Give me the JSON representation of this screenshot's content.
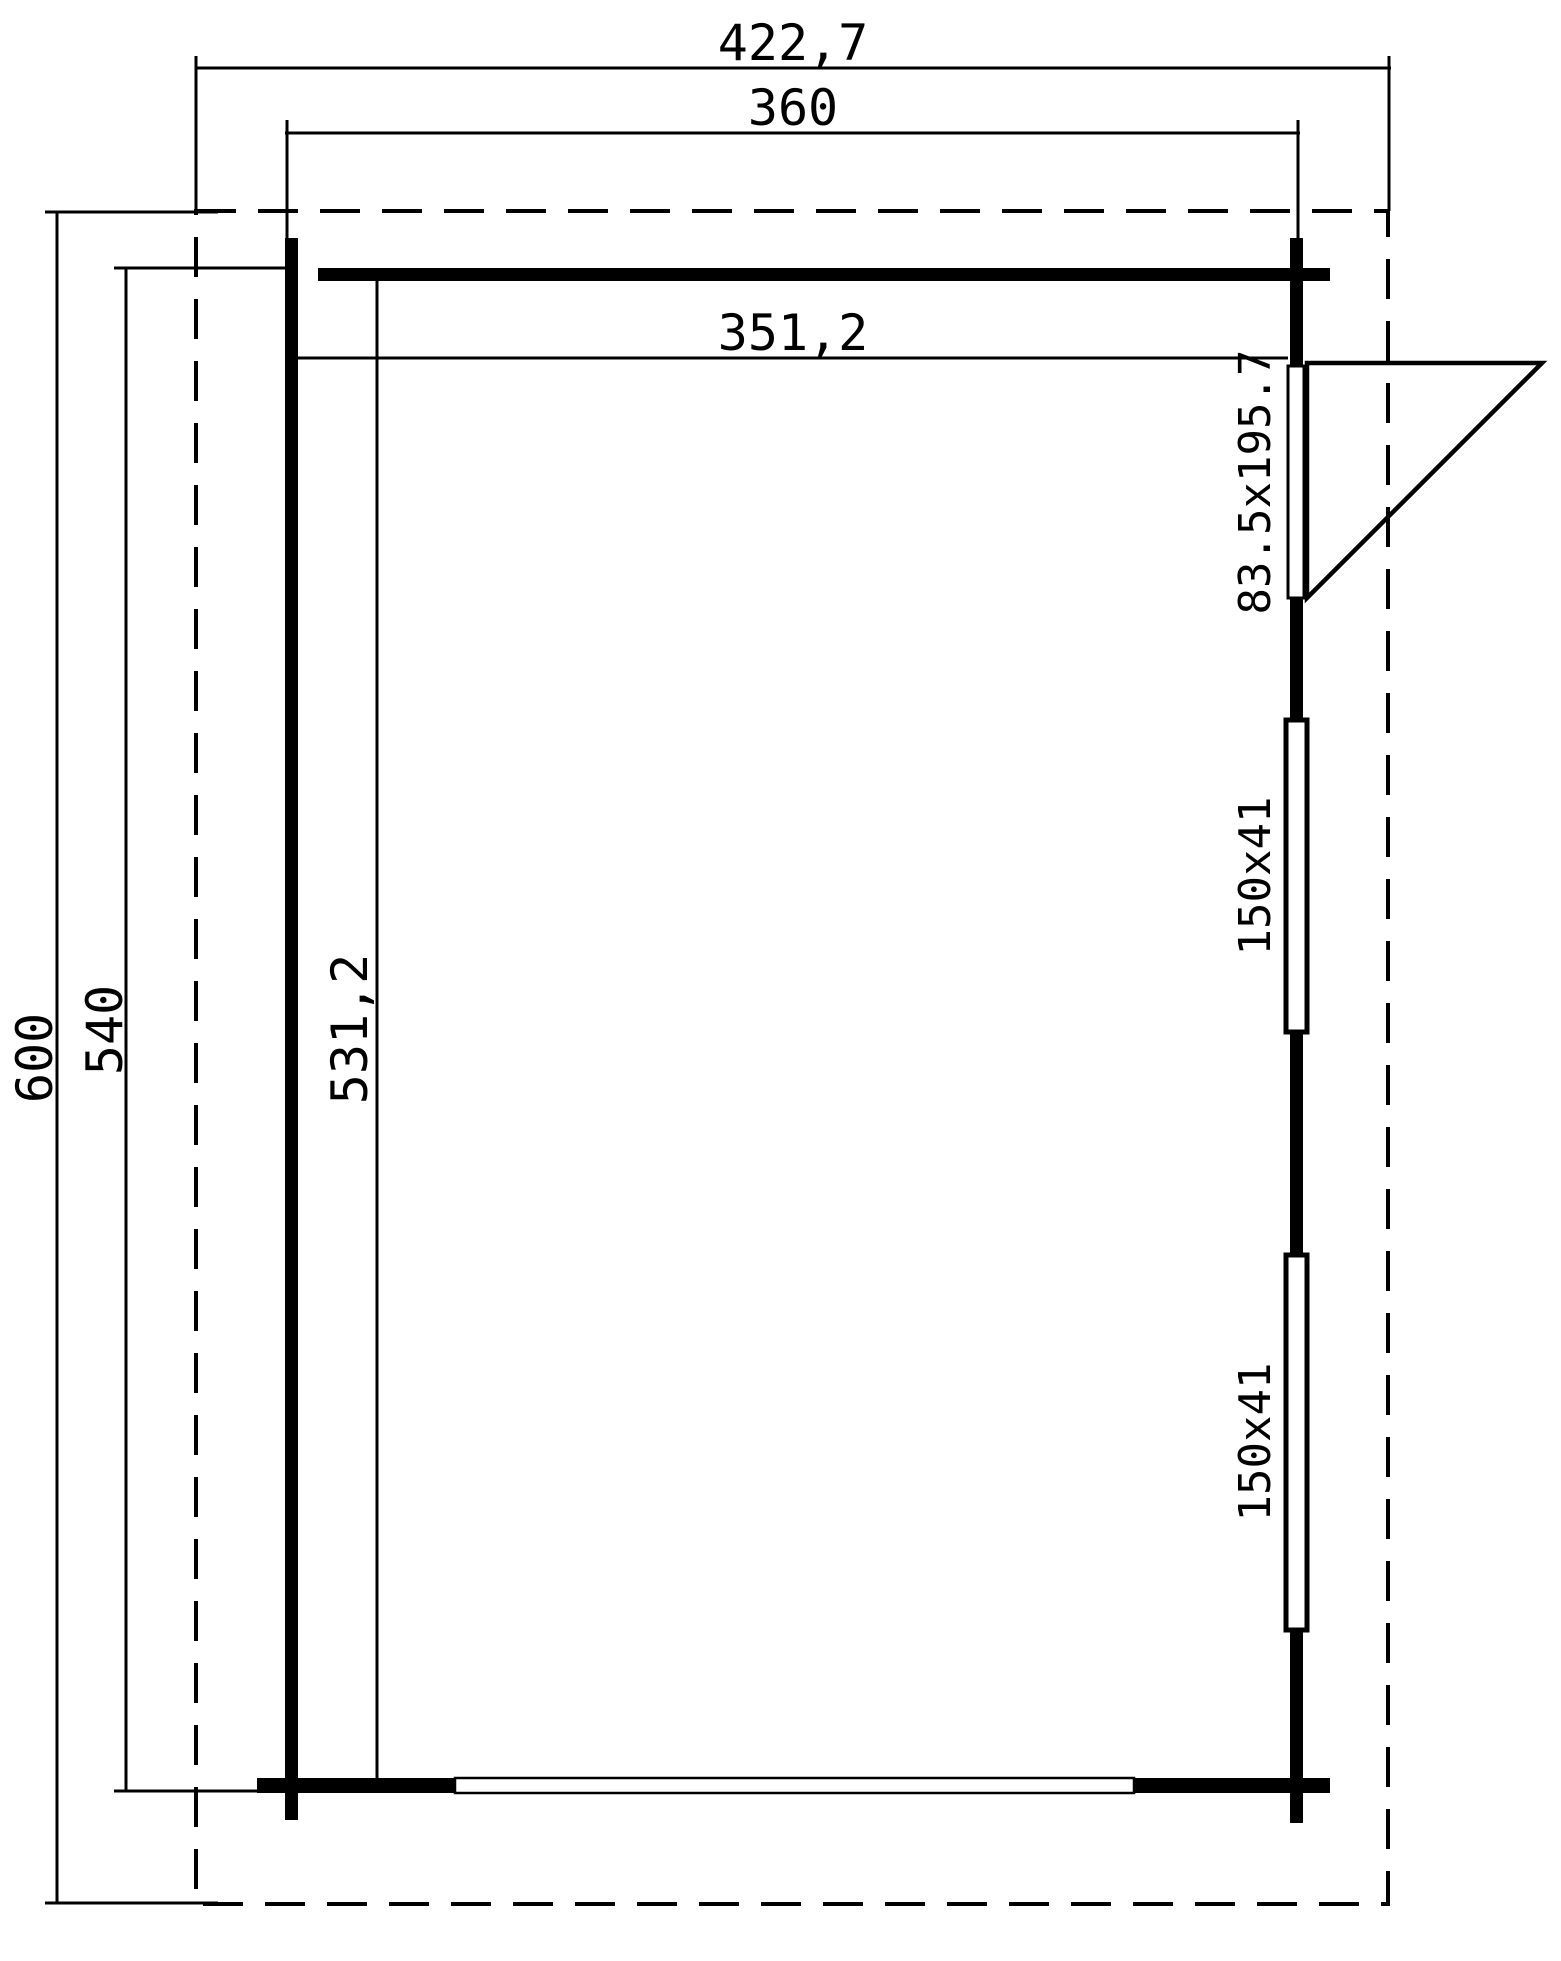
{
  "page": {
    "background_color": "#ffffff",
    "line_color": "#000000"
  },
  "plan": {
    "dimensions": {
      "outer_width": "422,7",
      "shell_width": "360",
      "inner_width": "351,2",
      "outer_depth": "600",
      "shell_depth": "540",
      "inner_depth": "531,2"
    },
    "openings": {
      "door_size": "83.5x195.7",
      "window_top_size": "150x41",
      "window_bottom_size": "150x41"
    }
  }
}
